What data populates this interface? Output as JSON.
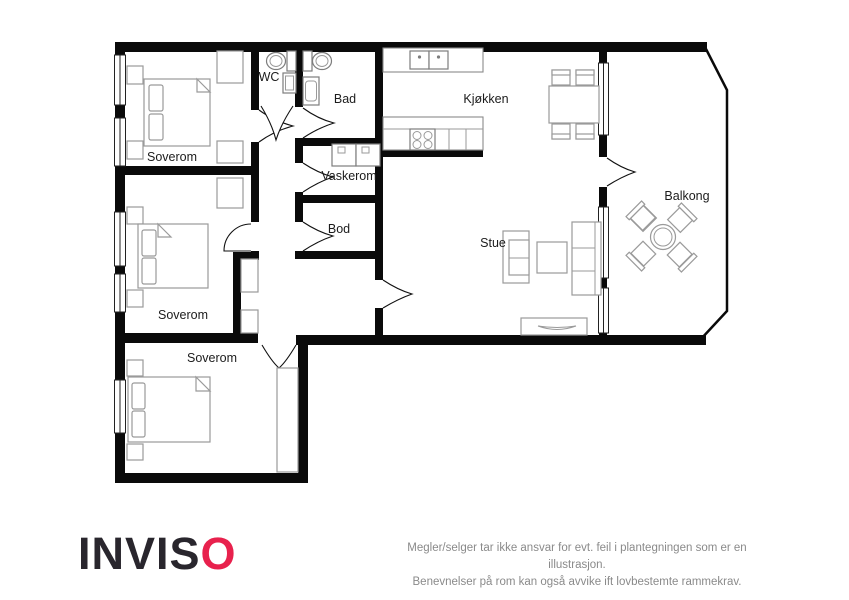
{
  "floorplan": {
    "rooms": {
      "bedroom1": "Soverom",
      "bedroom2": "Soverom",
      "bedroom3": "Soverom",
      "wc": "WC",
      "bathroom": "Bad",
      "laundry": "Vaskerom",
      "storage": "Bod",
      "kitchen": "Kjøkken",
      "living_room": "Stue",
      "balcony": "Balkong"
    }
  },
  "branding": {
    "logo_text_main": "INVIS",
    "logo_text_accent": "O",
    "logo_color_main": "#29262d",
    "logo_color_accent": "#e8214d"
  },
  "disclaimer": {
    "line1": "Megler/selger tar ikke ansvar for evt. feil i plantegningen som er en illustrasjon.",
    "line2": "Benevnelser på rom kan også avvike ift lovbestemte rammekrav."
  }
}
